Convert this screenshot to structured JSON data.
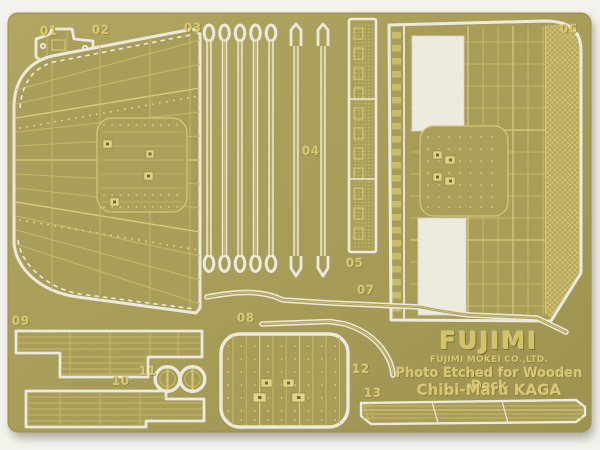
{
  "photo": {
    "subject": "photo-etched brass model parts sheet",
    "background_color": "#f3f2ec",
    "sheet_color": "#a89d57",
    "etch_bright_color": "#dfcf7c",
    "cut_line_color": "#f0eee3"
  },
  "branding": {
    "logo": "FUJIMI",
    "company": "FUJIMI MOKEI CO.,LTD.",
    "product_line1": "Photo Etched for Wooden Deck",
    "product_line2": "Chibi-Maru KAGA"
  },
  "parts": [
    {
      "number": "01"
    },
    {
      "number": "02"
    },
    {
      "number": "03"
    },
    {
      "number": "04"
    },
    {
      "number": "05"
    },
    {
      "number": "06"
    },
    {
      "number": "07"
    },
    {
      "number": "08"
    },
    {
      "number": "09"
    },
    {
      "number": "10"
    },
    {
      "number": "11"
    },
    {
      "number": "12"
    },
    {
      "number": "13"
    }
  ]
}
